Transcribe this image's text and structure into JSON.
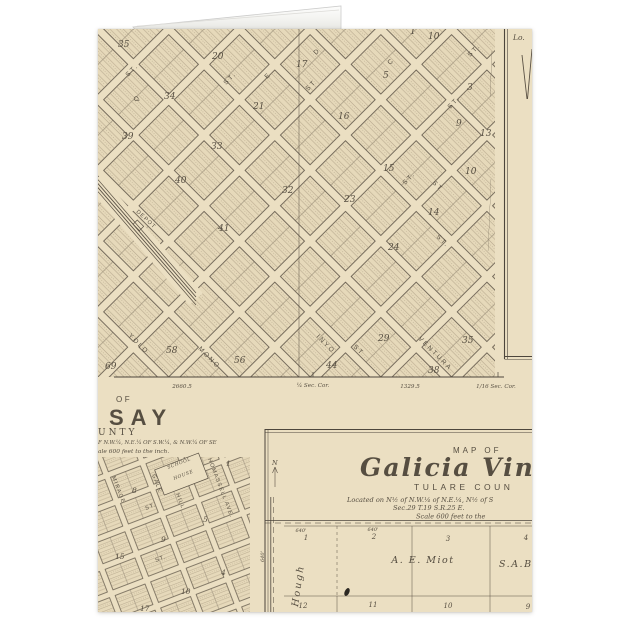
{
  "colors": {
    "background": "#ffffff",
    "paper": "#ebdfc2",
    "block_fill": "#e6d9ba",
    "ink": "#564e41",
    "hatch": "#a2937a",
    "fold": "#f4f4f1"
  },
  "main_map": {
    "block_numbers": [
      "35",
      "20",
      "17",
      "10",
      "1",
      "5",
      "3",
      "34",
      "21",
      "16",
      "9",
      "39",
      "33",
      "40",
      "32",
      "15",
      "13",
      "23",
      "14",
      "10",
      "41",
      "24",
      "69",
      "58",
      "56",
      "44",
      "29",
      "38",
      "35"
    ],
    "streets_nw": [
      "ST.",
      "Q",
      "ST.",
      "E",
      "D",
      "ST",
      "C",
      "ST.",
      "ST.",
      "ST."
    ],
    "streets_ne": [
      "YOLO",
      "MONO",
      "INYO",
      "VENTURA",
      "ST",
      "ST.",
      "ST"
    ],
    "depot": "DEPOT",
    "survey": {
      "d1": "2660.5",
      "c1": "¼ Sec. Cor.",
      "d2": "1329.5",
      "c2": "1/16 Sec. Cor."
    }
  },
  "right_panel": {
    "fragment": "Lo."
  },
  "lindsay": {
    "map_of": "OF",
    "title": "SAY",
    "county": "UNTY",
    "located": "F N.W.¼, N.E.¼ OF S.W.¼, & N.W.¼ OF SE",
    "scale": "ale 600 feet to the inch.",
    "school_line1": "SCHOOL",
    "school_line2": "HOUSE",
    "streets": {
      "mirage": "MIRAGE",
      "gale": "GALE",
      "hill": "HILL",
      "homassell": "HOMASSELL AVE.",
      "st1": "ST.",
      "st2": "ST."
    },
    "blocks": [
      "8",
      "1",
      "9",
      "5",
      "15",
      "10",
      "4",
      "17"
    ]
  },
  "galicia": {
    "map_of": "MAP OF",
    "title": "Galicia Vine",
    "county": "TULARE COUN",
    "located1": "Located on N½ of N.W.¼ of N.E.¼, N½ of S",
    "located2": "Sec.29 T.19 S.R.25 E.",
    "scale": "Scale 600 feet to the",
    "north": "N",
    "road": "Hough",
    "dims": {
      "a": "640'",
      "b": "640'",
      "side": "640'"
    },
    "lots_top": [
      "1",
      "2",
      "3",
      "4"
    ],
    "lots_bottom": [
      "12",
      "11",
      "10",
      "9"
    ],
    "owners": {
      "a": "A. E. Miot",
      "b": "S.A.BI"
    }
  }
}
